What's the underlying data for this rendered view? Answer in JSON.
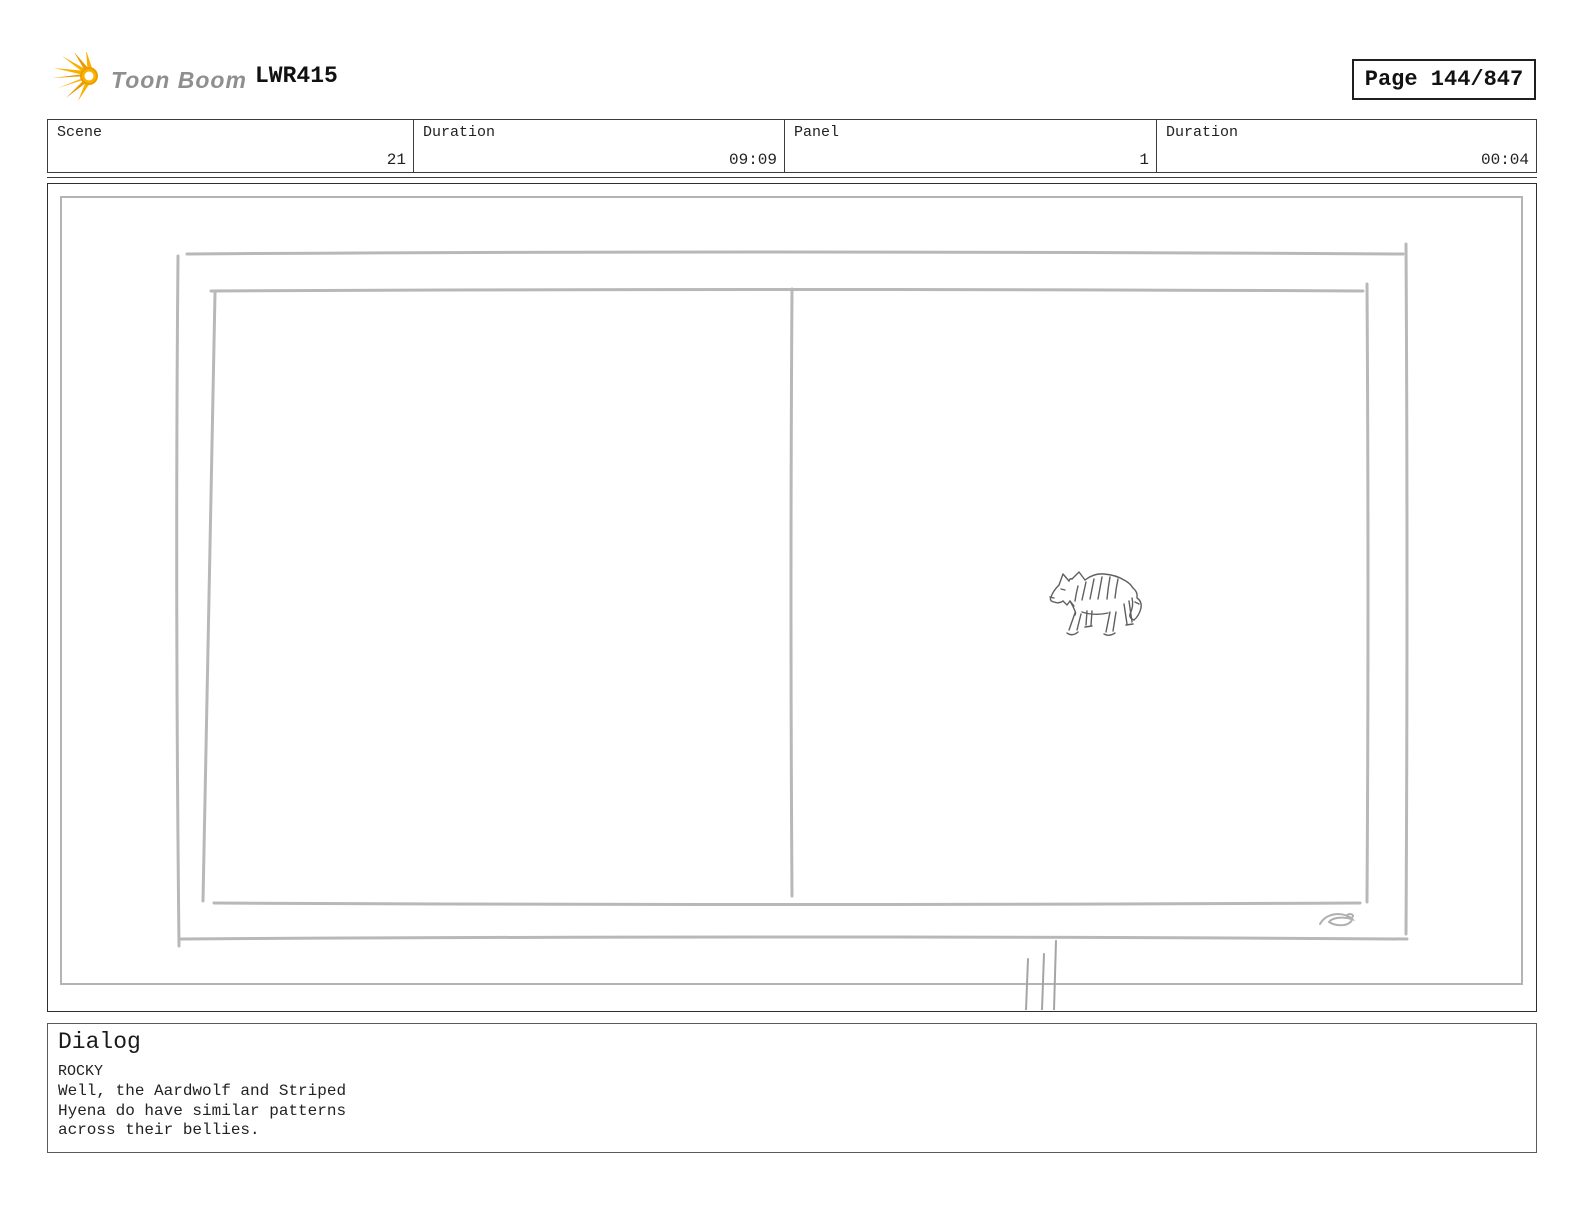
{
  "header": {
    "logo_text": "Toon Boom",
    "project_code": "LWR415",
    "page_label": "Page 144/847"
  },
  "meta_table": {
    "cells": [
      {
        "label": "Scene",
        "value": "21"
      },
      {
        "label": "Duration",
        "value": "09:09"
      },
      {
        "label": "Panel",
        "value": "1"
      },
      {
        "label": "Duration",
        "value": "00:04"
      }
    ]
  },
  "panel": {
    "sketch": "striped-hyena-pencil-sketch-in-double-frame"
  },
  "dialog": {
    "title": "Dialog",
    "character": "ROCKY",
    "lines": [
      "Well, the Aardwolf and Striped",
      "Hyena do have similar patterns",
      "across their bellies."
    ]
  },
  "colors": {
    "logo_yellow": "#F9B000",
    "logo_yellow_dark": "#E89A00",
    "logo_text_gray": "#8F8F8F",
    "sketch_gray": "#B8B8B8",
    "animal_ink": "#5F5F5F",
    "border_dark": "#3C3C3C"
  }
}
